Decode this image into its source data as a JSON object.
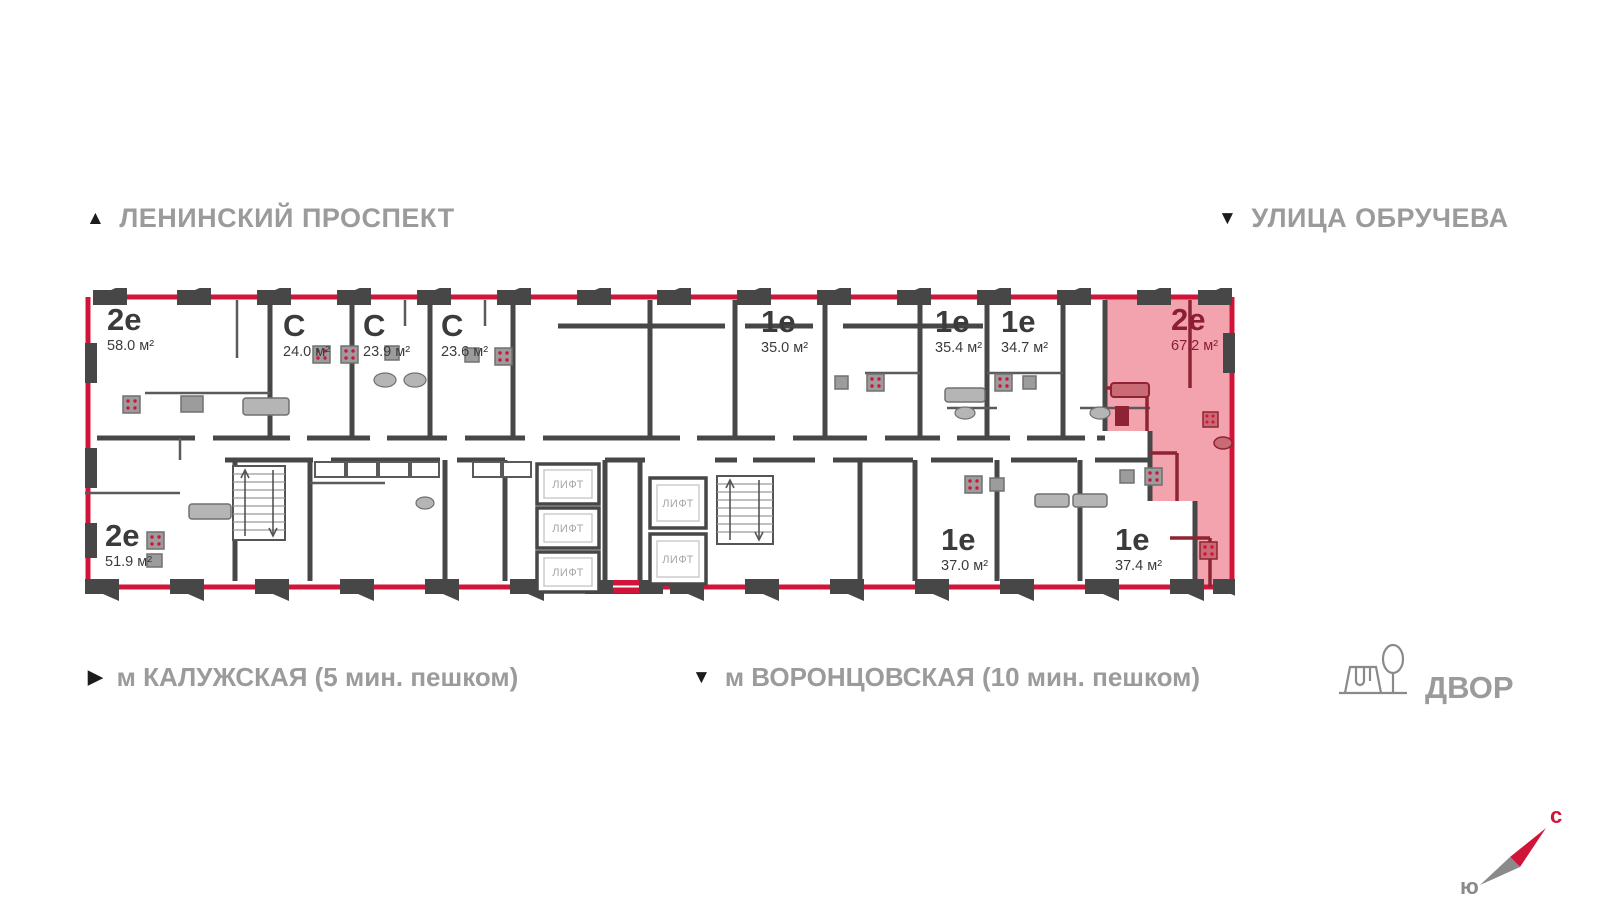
{
  "streets": {
    "top_left": "ЛЕНИНСКИЙ ПРОСПЕКТ",
    "top_right": "УЛИЦА ОБРУЧЕВА"
  },
  "metro": {
    "left": "м КАЛУЖСКАЯ (5 мин. пешком)",
    "center": "м ВОРОНЦОВСКАЯ  (10 мин. пешком)"
  },
  "yard_label": "ДВОР",
  "compass": {
    "north": "с",
    "south": "ю"
  },
  "elevator_label": "ЛИФТ",
  "apartments": [
    {
      "type": "2е",
      "area": "58.0 м²",
      "highlighted": false
    },
    {
      "type": "С",
      "area": "24.0 м²",
      "highlighted": false
    },
    {
      "type": "С",
      "area": "23.9 м²",
      "highlighted": false
    },
    {
      "type": "С",
      "area": "23.6 м²",
      "highlighted": false
    },
    {
      "type": "1е",
      "area": "35.0 м²",
      "highlighted": false
    },
    {
      "type": "1е",
      "area": "35.4 м²",
      "highlighted": false
    },
    {
      "type": "1е",
      "area": "34.7 м²",
      "highlighted": false
    },
    {
      "type": "2е",
      "area": "67.2 м²",
      "highlighted": true
    },
    {
      "type": "2е",
      "area": "51.9 м²",
      "highlighted": false
    },
    {
      "type": "1е",
      "area": "37.0 м²",
      "highlighted": false
    },
    {
      "type": "1е",
      "area": "37.4 м²",
      "highlighted": false
    }
  ],
  "colors": {
    "facade_red": "#d0143a",
    "wall_gray": "#474747",
    "highlight_fill": "#f2a3ad",
    "highlight_wall": "#8e2433",
    "text_gray": "#9b9b9b",
    "label_dark": "#3b3b3b"
  }
}
